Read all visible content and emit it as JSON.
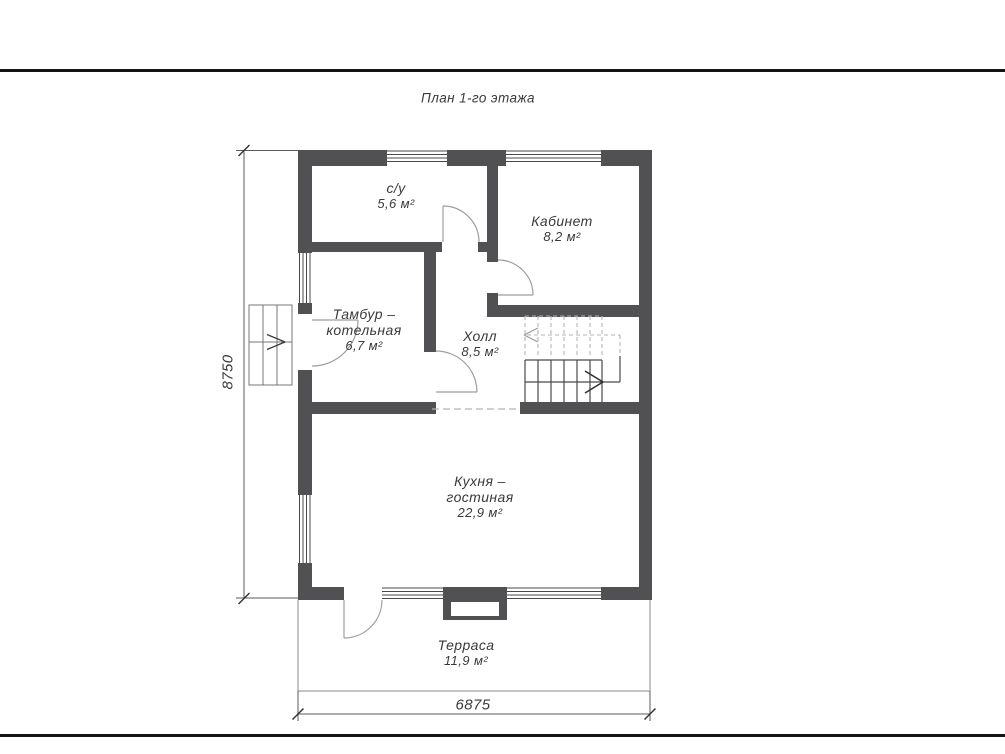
{
  "page": {
    "title": "План 1-го этажа"
  },
  "floor_plan": {
    "rooms": [
      {
        "name": "с/у",
        "area": "5,6 м²"
      },
      {
        "name": "Кабинет",
        "area": "8,2 м²"
      },
      {
        "name": "Тамбур –",
        "name2": "котельная",
        "area": "6,7 м²"
      },
      {
        "name": "Холл",
        "area": "8,5 м²"
      },
      {
        "name": "Кухня –",
        "name2": "гостиная",
        "area": "22,9 м²"
      },
      {
        "name": "Терраса",
        "area": "11,9 м²"
      }
    ],
    "dimensions": {
      "height_mm": "8750",
      "width_mm": "6875"
    }
  },
  "colors": {
    "wall": "#515153",
    "thin_line": "#8a8a8a",
    "dashed_line": "#b4b4b4",
    "text": "#3a3a3a",
    "page_border": "#151515"
  }
}
